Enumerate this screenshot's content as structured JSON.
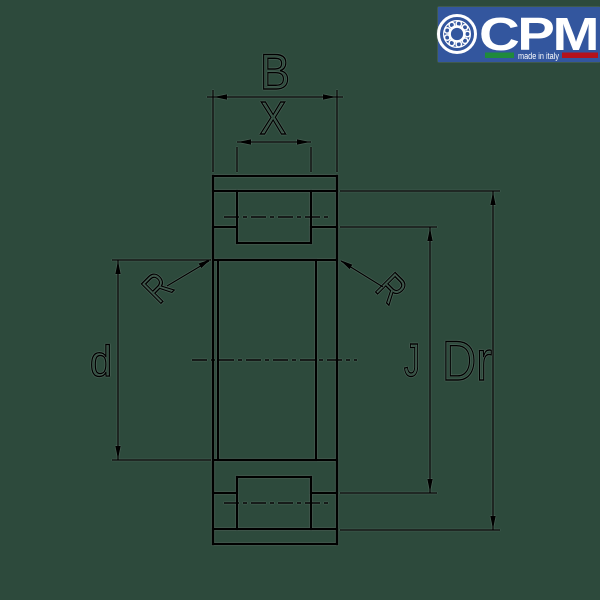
{
  "logo": {
    "brand": "CPM",
    "tagline": "made in italy"
  },
  "drawing": {
    "labels": {
      "B": "B",
      "X": "X",
      "d": "d",
      "J": "J",
      "Dr": "Dr",
      "R_left": "R",
      "R_right": "R"
    }
  },
  "colors": {
    "background": "#2d4a3c",
    "line": "#000000",
    "logo_blue": "#33569e",
    "logo_white": "#ffffff",
    "flag_green": "#1f8a3c",
    "flag_red": "#b5121b"
  }
}
